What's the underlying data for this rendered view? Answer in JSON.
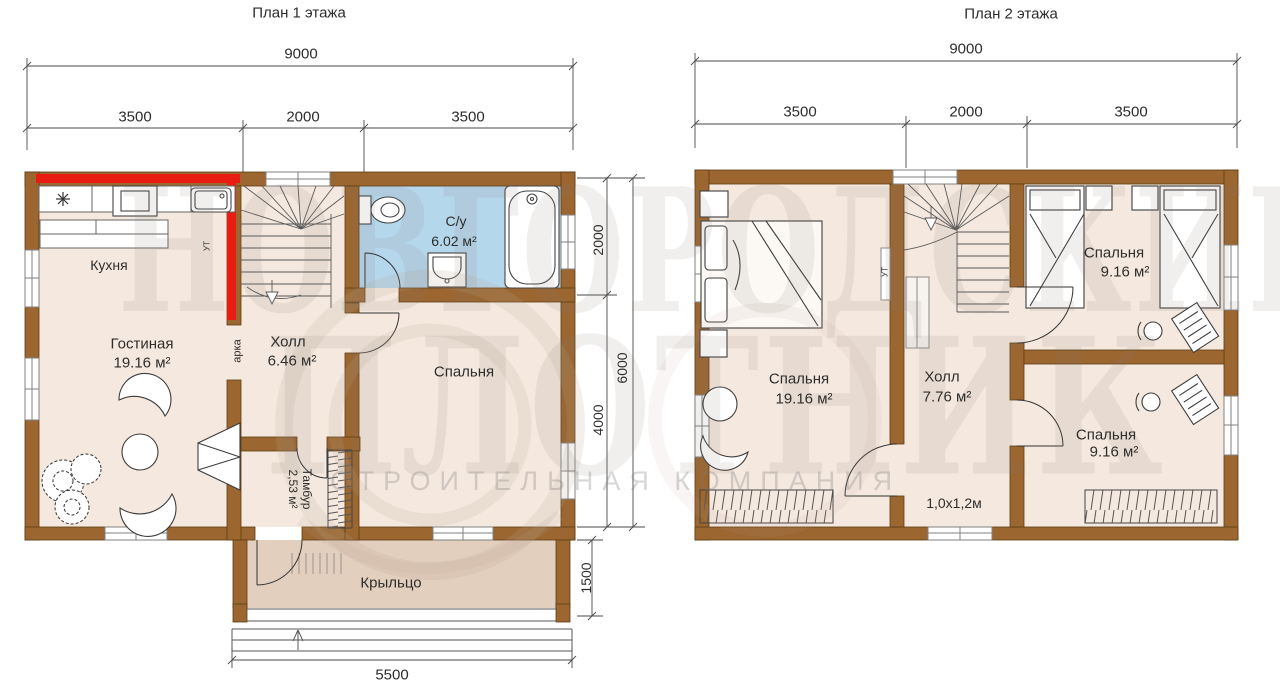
{
  "floor1": {
    "title": "План 1 этажа",
    "dims": {
      "total": "9000",
      "seg1": "3500",
      "seg2": "2000",
      "seg3": "3500",
      "side_top": "2000",
      "side_bottom": "4000",
      "side_total": "6000",
      "porch_height": "1500",
      "bottom": "5500"
    },
    "rooms": {
      "kitchen": {
        "name": "Кухня"
      },
      "living": {
        "name": "Гостиная",
        "area": "19.16 м²"
      },
      "hall": {
        "name": "Холл",
        "area": "6.46 м²"
      },
      "bathroom": {
        "name": "С/у",
        "area": "6.02 м²"
      },
      "bedroom": {
        "name": "Спальня"
      },
      "tambour": {
        "name": "Тамбур",
        "area": "2,53 м²"
      },
      "porch": {
        "name": "Крыльцо"
      }
    },
    "annotations": {
      "arch": "арка",
      "ut": "УТ"
    }
  },
  "floor2": {
    "title": "План 2 этажа",
    "dims": {
      "total": "9000",
      "seg1": "3500",
      "seg2": "2000",
      "seg3": "3500"
    },
    "rooms": {
      "bedroom_main": {
        "name": "Спальня",
        "area": "19.16 м²"
      },
      "hall": {
        "name": "Холл",
        "area": "7.76 м²"
      },
      "bedroom_top": {
        "name": "Спальня",
        "area": "9.16 м²"
      },
      "bedroom_bottom": {
        "name": "Спальня",
        "area": "9.16 м²"
      }
    },
    "annotations": {
      "window_size": "1,0х1,2м",
      "ut": "УТ"
    }
  },
  "watermark": {
    "line1": "НОВГОРОДСКИЙ",
    "line2": "ПЛОТНИК",
    "line3": "СТРОИТЕЛЬНАЯ КОМПАНИЯ"
  },
  "colors": {
    "wall": "#9b6630",
    "floor": "#f5e9df",
    "bathroom_floor": "#b5d7ec",
    "porch_floor": "#e3cfbe",
    "highlight_red": "#e81c10"
  }
}
